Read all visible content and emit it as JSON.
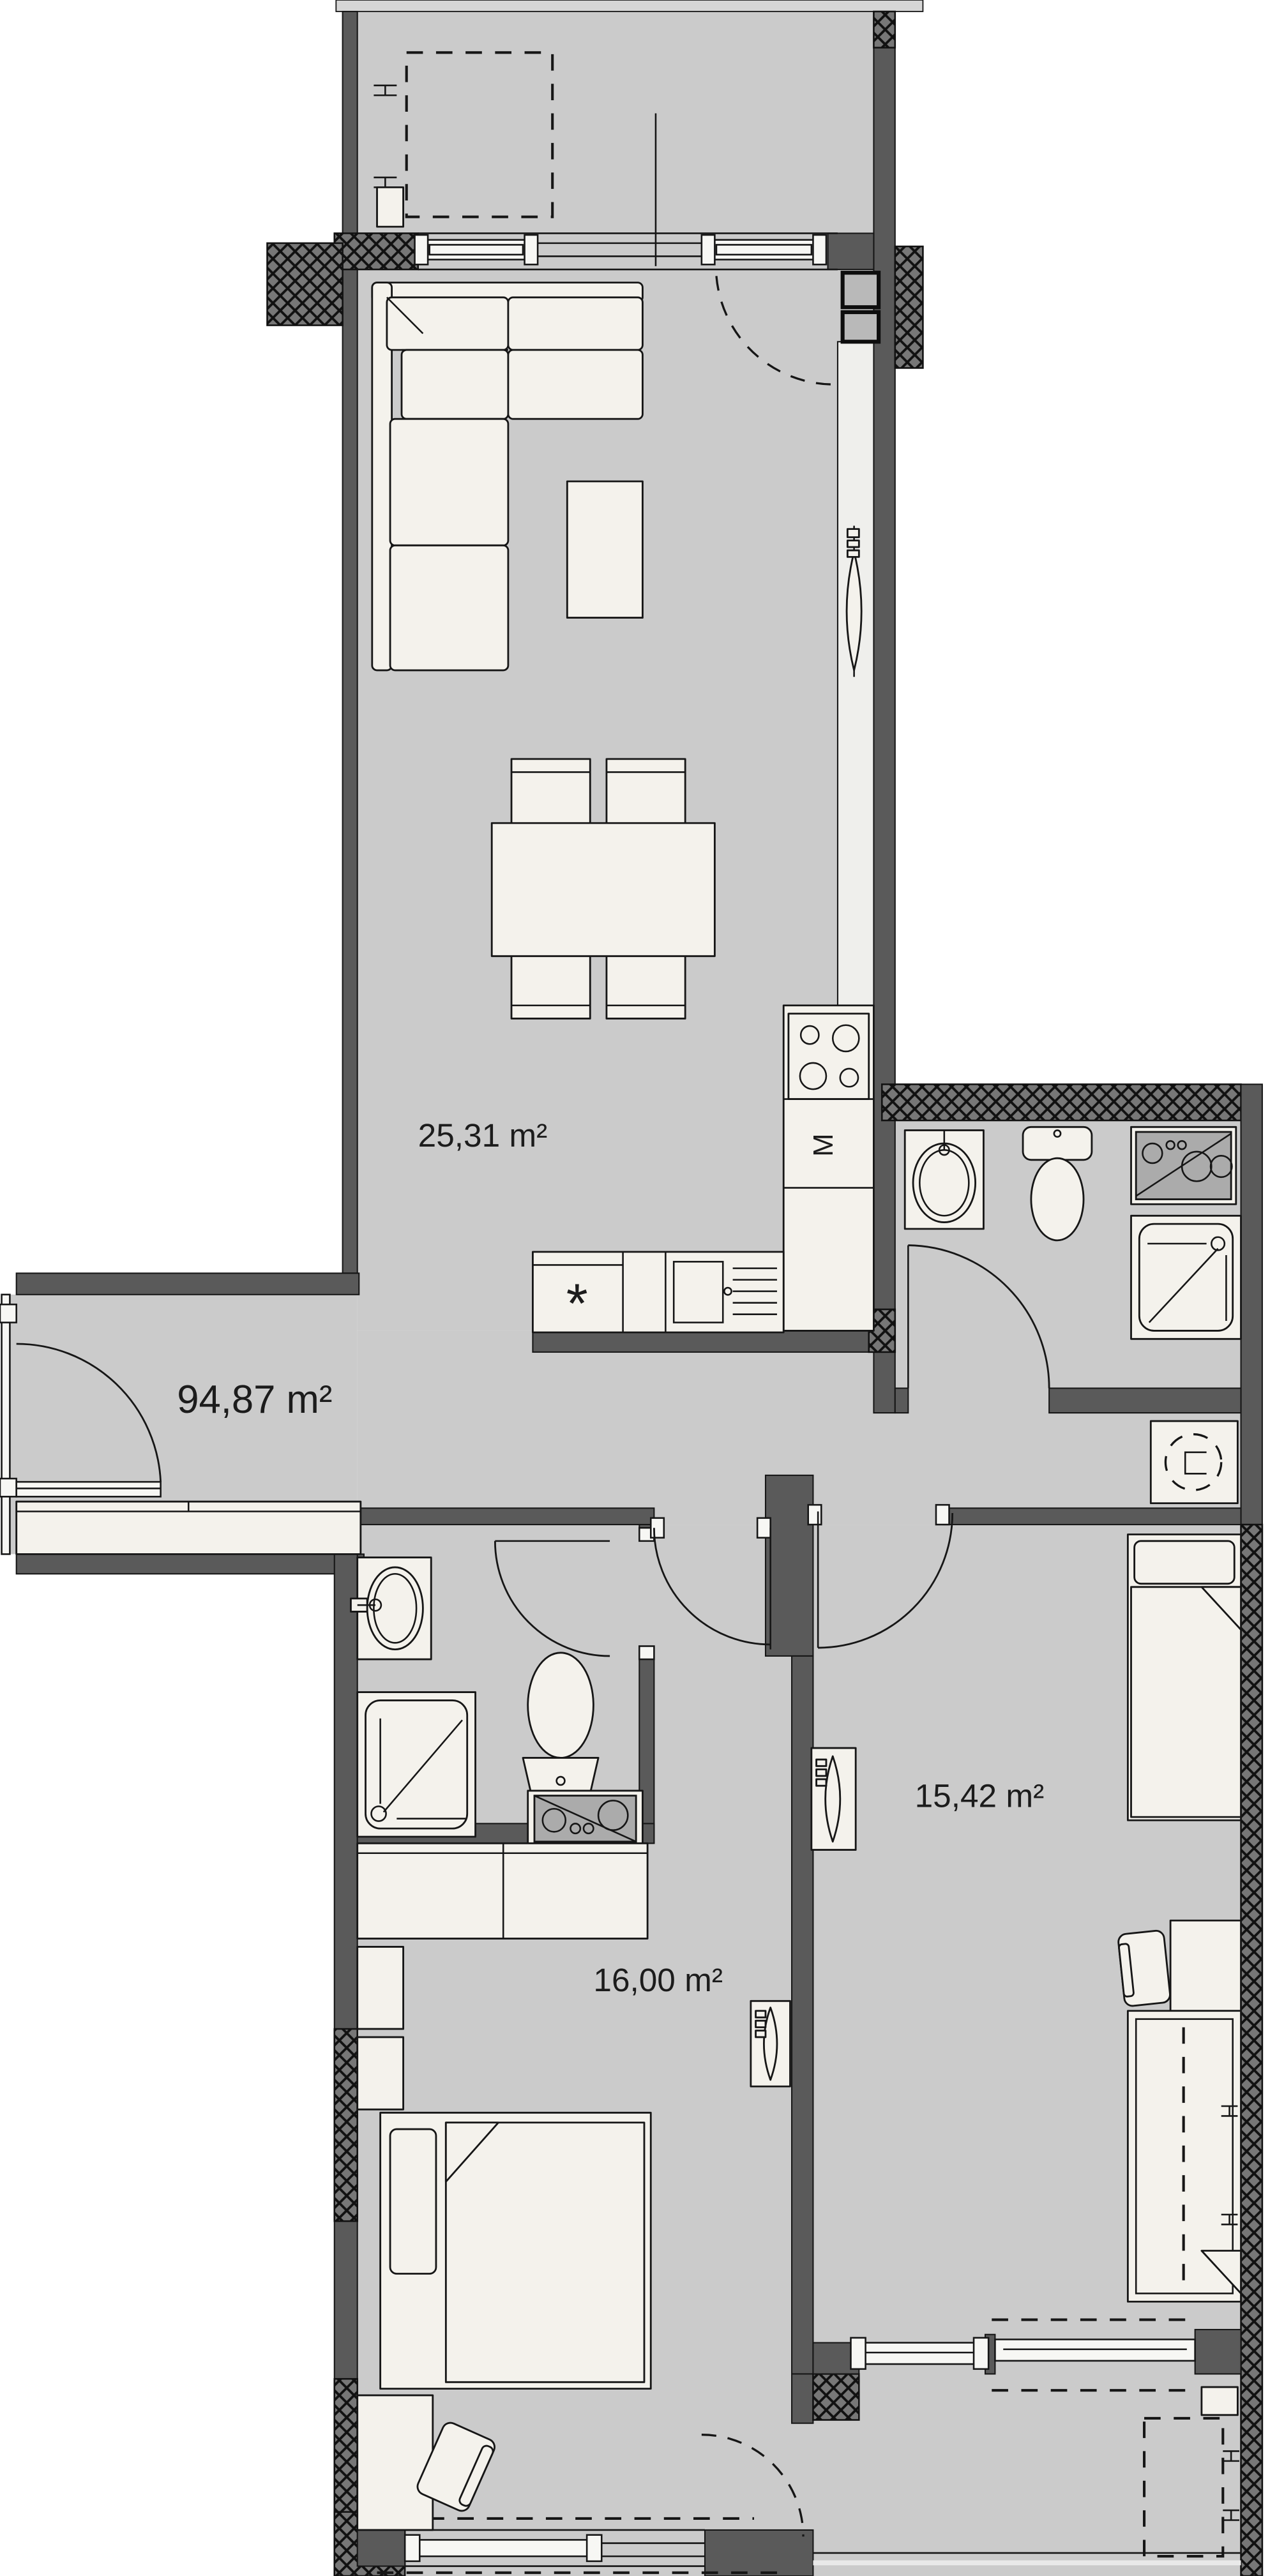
{
  "floorplan": {
    "total_area_label": "94,87 m²",
    "living_kitchen_area_label": "25,31 m²",
    "bedroom_left_area_label": "16,00 m²",
    "bedroom_right_area_label": "15,42 m²",
    "kitchen_appliance_label": "M",
    "kitchen_fridge_symbol": "*",
    "colors": {
      "floor": "#cbcbcb",
      "wall": "#5a5a5a",
      "insulation_hatch": "#777777",
      "furniture": "#f4f2ec",
      "outline": "#161616",
      "background": "#ffffff"
    }
  }
}
